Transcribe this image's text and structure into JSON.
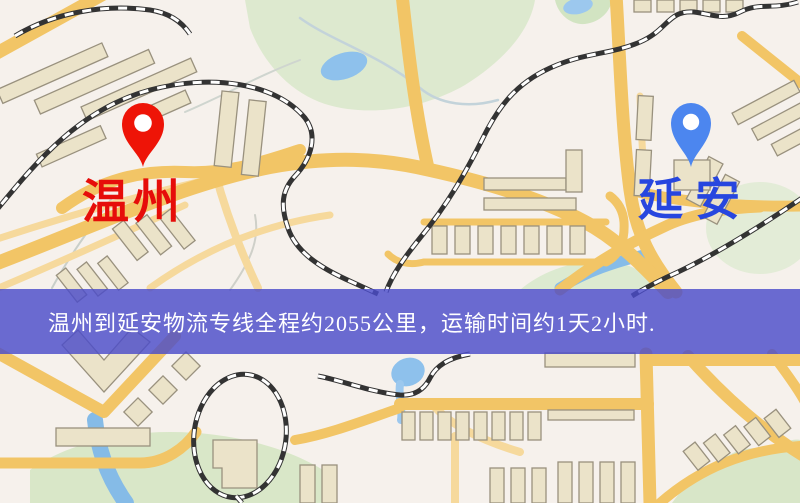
{
  "page": {
    "type": "logistics-route-map",
    "width": 800,
    "height": 503
  },
  "markers": {
    "origin": {
      "label": "温州",
      "pin_color": "#ee1407",
      "label_color": "#e60d0a"
    },
    "destination": {
      "label": "延安",
      "pin_color": "#4c86ef",
      "label_color": "#2746df"
    }
  },
  "banner": {
    "text": "温州到延安物流专线全程约2055公里，运输时间约1天2小时.",
    "background_color": "#4a4cc9",
    "text_color": "#ffffff"
  },
  "map_palette": {
    "background": "#f6f1ec",
    "road_major": "#f2c566",
    "road_minor": "#f6d99c",
    "building_fill": "#ebe3c9",
    "building_stroke": "#99917e",
    "park_green": "#dde9cf",
    "water_blue": "#8ec1ec",
    "railway_dark": "#333333"
  }
}
